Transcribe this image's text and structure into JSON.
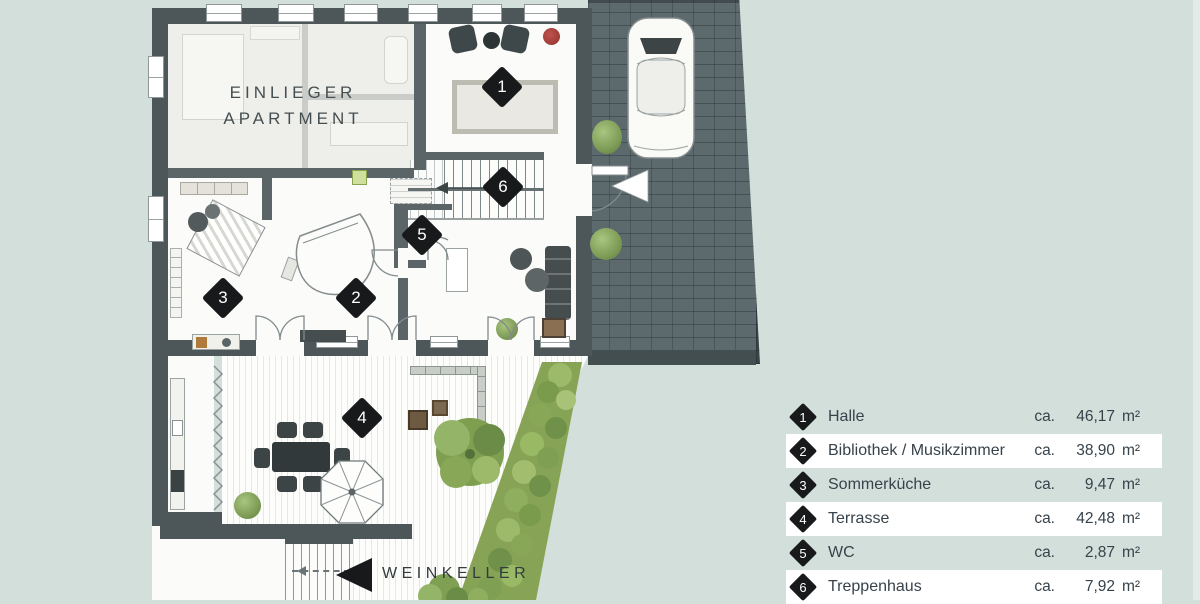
{
  "plan": {
    "apartment_label": {
      "line1": "EINLIEGER",
      "line2": "APARTMENT"
    },
    "weinkeller_label": "WEINKELLER",
    "markers": {
      "halle": "1",
      "bibliothek_musikzimmer": "2",
      "sommerkueche": "3",
      "terrasse": "4",
      "wc": "5",
      "treppenhaus": "6"
    }
  },
  "legend": {
    "rows": [
      {
        "num": "1",
        "label": "Halle",
        "ca": "ca.",
        "value": "46,17",
        "unit": "m²"
      },
      {
        "num": "2",
        "label": "Bibliothek / Musikzimmer",
        "ca": "ca.",
        "value": "38,90",
        "unit": "m²"
      },
      {
        "num": "3",
        "label": "Sommerküche",
        "ca": "ca.",
        "value": "9,47",
        "unit": "m²"
      },
      {
        "num": "4",
        "label": "Terrasse",
        "ca": "ca.",
        "value": "42,48",
        "unit": "m²"
      },
      {
        "num": "5",
        "label": "WC",
        "ca": "ca.",
        "value": "2,87",
        "unit": "m²"
      },
      {
        "num": "6",
        "label": "Treppenhaus",
        "ca": "ca.",
        "value": "7,92",
        "unit": "m²"
      }
    ]
  },
  "colors": {
    "background": "#d3dfdb",
    "wall": "#4d5759",
    "paving": "#5c696d",
    "marker": "#17191b",
    "legend_row_highlight": "#ffffff",
    "text": "#37424a",
    "hedge_green": "#87a456",
    "accent_red": "#a33c36"
  }
}
